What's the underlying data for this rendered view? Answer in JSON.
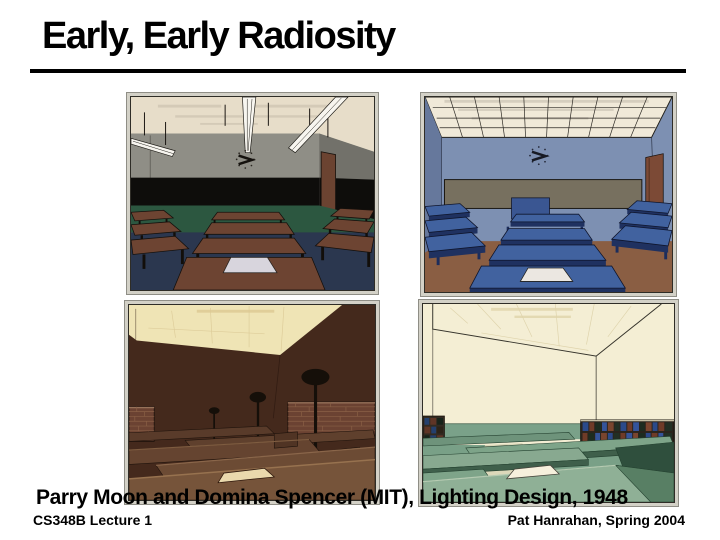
{
  "slide": {
    "title": "Early, Early Radiosity",
    "caption": "Parry Moon and Domina Spencer (MIT), Lighting Design, 1948",
    "background": "#ffffff",
    "text_color": "#000000"
  },
  "footer": {
    "left": "CS348B Lecture 1",
    "right": "Pat Hanrahan, Spring 2004"
  },
  "figures": [
    {
      "name": "classroom-suspended-fluorescent-gray",
      "palette": {
        "ceiling": "#e7ddc9",
        "wall": "#8f8e86",
        "blackboard": "#0e0d0b",
        "wainscot": "#2c5740",
        "floor": "#2b374f",
        "desk": "#6d4432",
        "paper": "#d8d5dd"
      }
    },
    {
      "name": "classroom-luminous-grid-ceiling-blue",
      "palette": {
        "ceiling": "#f0e9d8",
        "wall": "#7d90b2",
        "blackboard": "#77705f",
        "door": "#7c4a36",
        "floor": "#8a5e43",
        "desk": "#41629f",
        "paper": "#ebe7e1"
      }
    },
    {
      "name": "classroom-indirect-uplight-brown",
      "palette": {
        "ceiling": "#efe4b5",
        "wall": "#44291c",
        "desk": "#6c4b34",
        "lamp": "#150f09",
        "brick": "#6b4232",
        "paper": "#ead9ad"
      }
    },
    {
      "name": "classroom-bright-cream-green",
      "palette": {
        "wall": "#f4eed4",
        "band": "#7aa189",
        "desk": "#8fb096",
        "desk_side": "#2f4f3d",
        "books_blue": "#2b4a8a",
        "books_brown": "#6f3b28",
        "paper": "#f6f0dc"
      }
    }
  ]
}
